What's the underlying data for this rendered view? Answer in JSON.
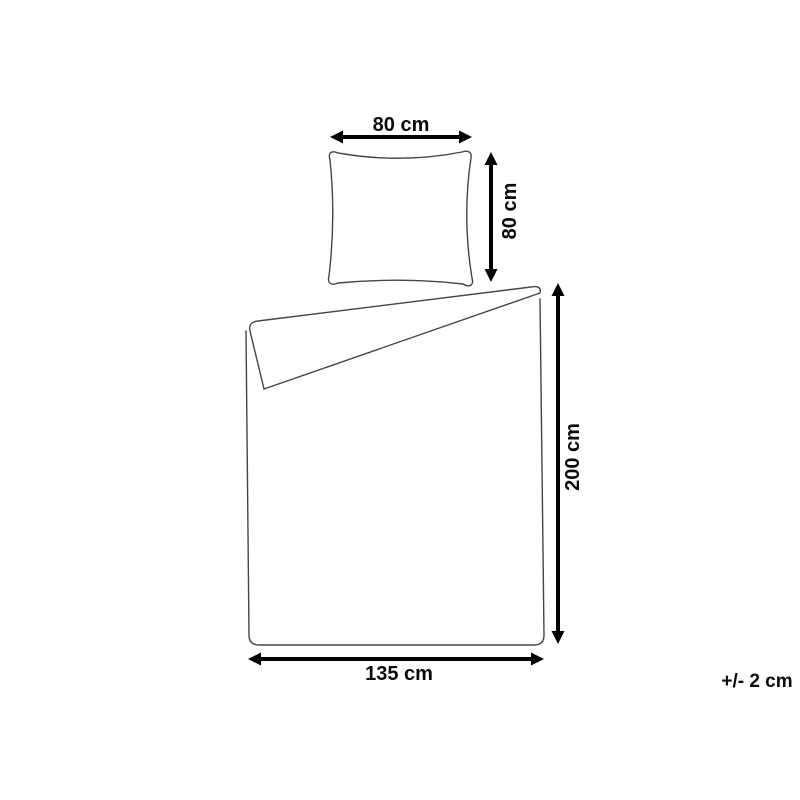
{
  "diagram": {
    "subject": "bedding-set-dimensions",
    "pillow": {
      "width_label": "80 cm",
      "height_label": "80 cm"
    },
    "duvet": {
      "height_label": "200 cm",
      "width_label": "135 cm"
    },
    "tolerance_label": "+/- 2 cm",
    "colors": {
      "background": "#ffffff",
      "outline": "#454545",
      "arrow": "#000000",
      "text": "#0a0a0a"
    }
  }
}
